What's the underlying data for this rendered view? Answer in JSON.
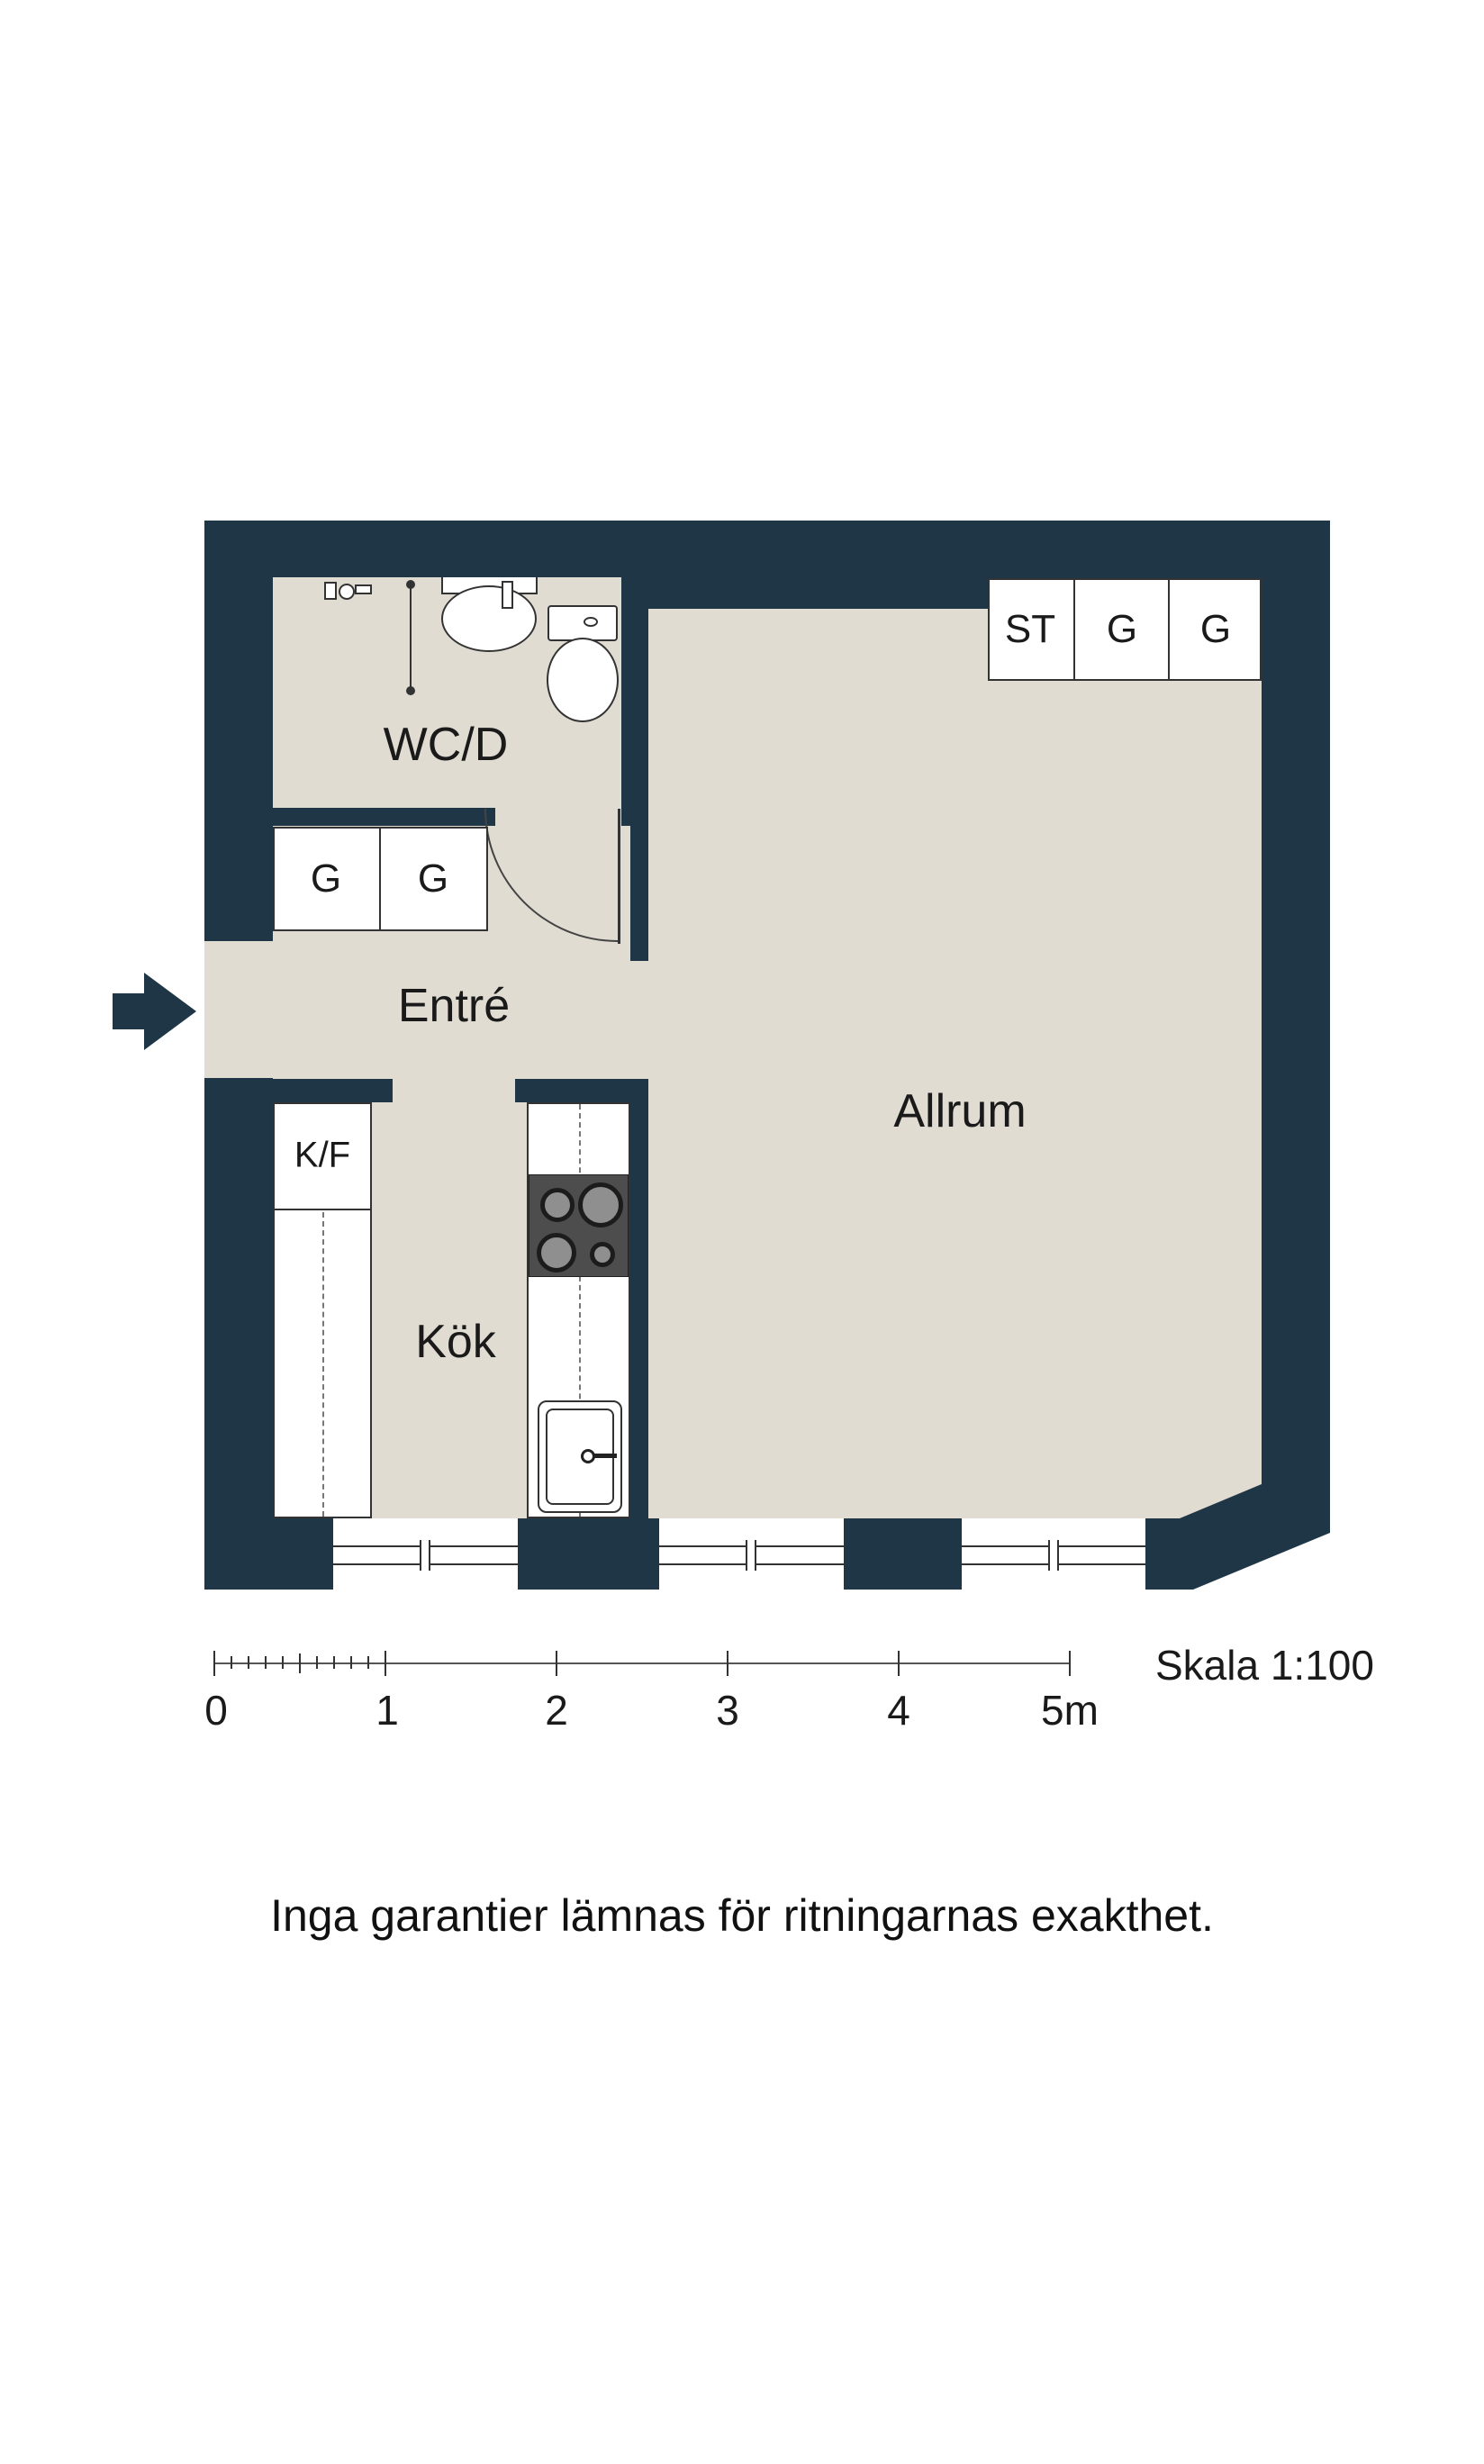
{
  "floorplan": {
    "rooms": [
      {
        "id": "wcd",
        "label": "WC/D"
      },
      {
        "id": "entre",
        "label": "Entré"
      },
      {
        "id": "kok",
        "label": "Kök"
      },
      {
        "id": "allrum",
        "label": "Allrum"
      }
    ],
    "cabinets": {
      "kf_label": "K/F",
      "entre_closets": [
        "G",
        "G"
      ],
      "allrum_closets": [
        "ST",
        "G",
        "G"
      ]
    },
    "scale_bar": {
      "tick_labels": [
        "0",
        "1",
        "2",
        "3",
        "4",
        "5m"
      ],
      "title": "Skala 1:100"
    },
    "disclaimer": "Inga garantier lämnas för ritningarnas exakthet.",
    "colors": {
      "wall": "#1f3647",
      "floor": "#e1dcd2",
      "fixture_outline": "#333333",
      "stove": "#4d4d4d",
      "burner_ring": "#1c1c1c",
      "burner_center": "#8f8f8f"
    }
  }
}
